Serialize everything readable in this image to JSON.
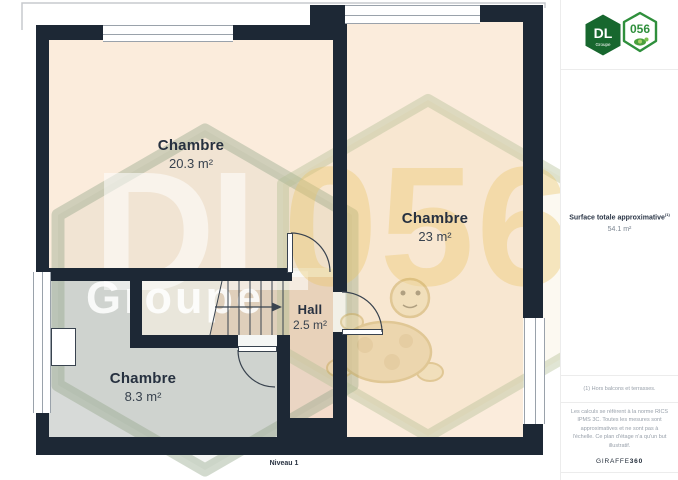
{
  "plan": {
    "level_label": "Niveau 1",
    "rooms": [
      {
        "name": "Chambre",
        "area": "20.3 m²"
      },
      {
        "name": "Chambre",
        "area": "23 m²"
      },
      {
        "name": "Hall",
        "area": "2.5 m²"
      },
      {
        "name": "Chambre",
        "area": "8.3 m²"
      }
    ]
  },
  "watermark": {
    "dl": "DL",
    "groupe": "Groupe",
    "code": "056"
  },
  "sidebar": {
    "logo": {
      "dl": "DL",
      "groupe": "Groupe",
      "code": "056"
    },
    "surface_label": "Surface totale approximative",
    "surface_note_ref": "(1)",
    "surface_value": "54.1 m²",
    "footnote": "(1) Hors balcons et terrasses.",
    "disclaimer": "Les calculs se réfèrent à la norme RICS IPMS 3C. Toutes les mesures sont approximatives et ne sont pas à l'échelle. Ce plan d'étage n'a qu'un but illustratif.",
    "brand_name": "GIRAFFE",
    "brand_suffix": "360"
  },
  "colors": {
    "wall": "#1d2835",
    "room_beige": "#fbecdc",
    "hall_pink": "#f4dccb",
    "room_gray": "#d7dad8",
    "stairs_pale": "#f3eee5",
    "stairs_steps": "#e8d5c2",
    "logo_dark_green": "#17672e",
    "logo_green": "#2f8f3c",
    "watermark_yellow": "#e8c46a"
  }
}
